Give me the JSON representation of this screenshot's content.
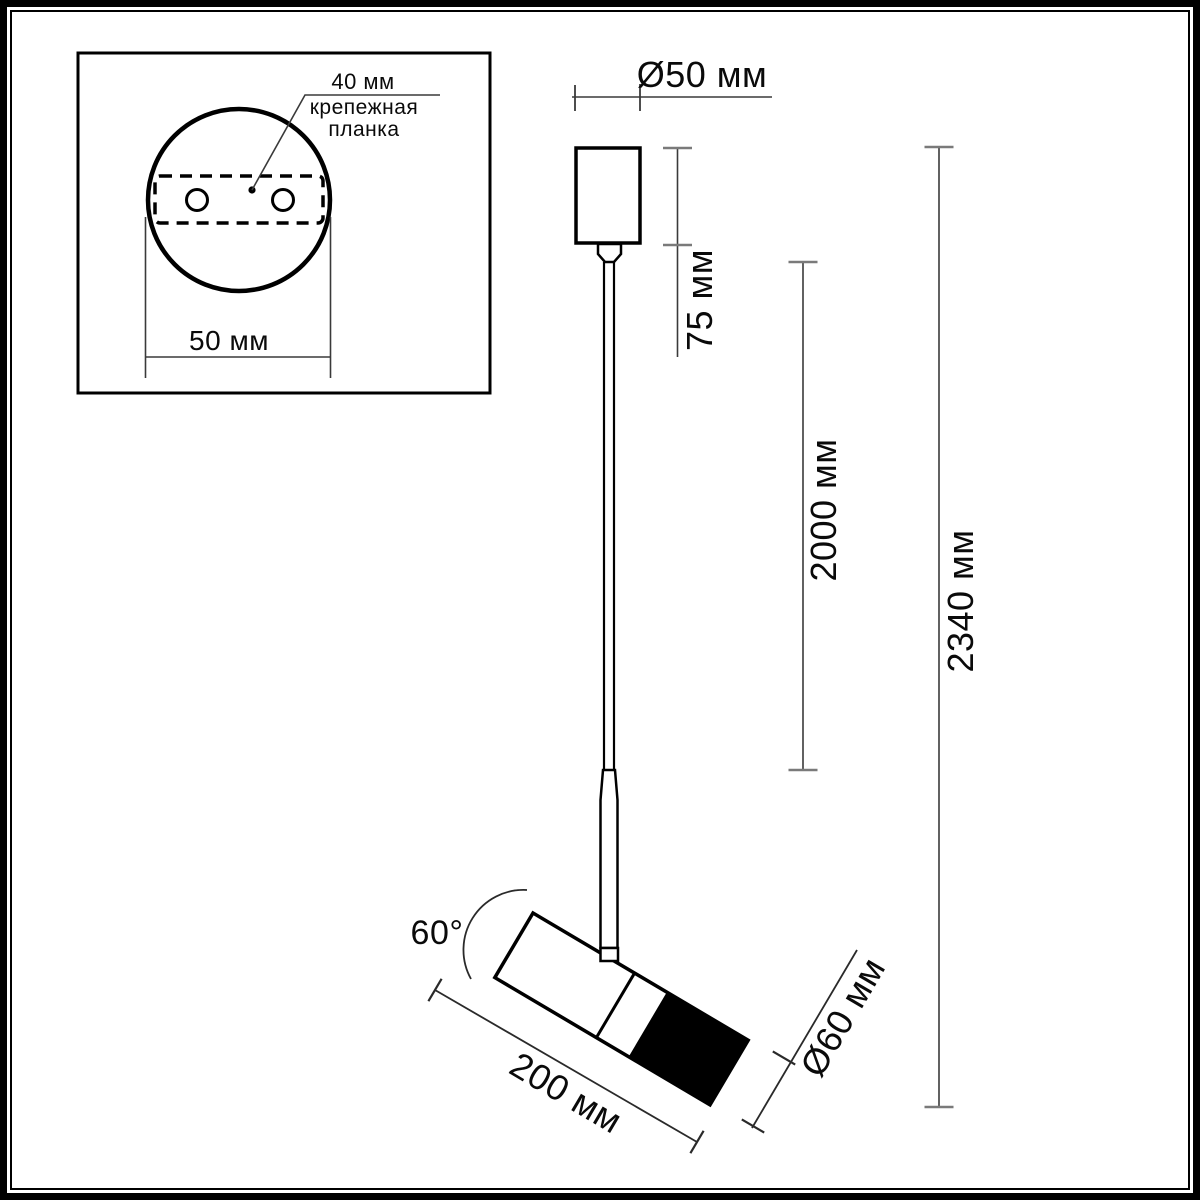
{
  "inset": {
    "hole_spacing_label": "40 мм",
    "mount_plate_line1": "крепежная",
    "mount_plate_line2": "планка",
    "plate_width_label": "50 мм"
  },
  "dimensions": {
    "canopy_diameter": "Ø50 мм",
    "canopy_height": "75 мм",
    "suspension_length": "2000 мм",
    "total_height": "2340 мм",
    "head_length": "200 мм",
    "head_diameter": "Ø60 мм",
    "tilt_angle": "60°"
  },
  "colors": {
    "line": "#000000",
    "dim_line": "#3a3a3a",
    "tick": "#7a7a7a",
    "background": "#ffffff"
  }
}
